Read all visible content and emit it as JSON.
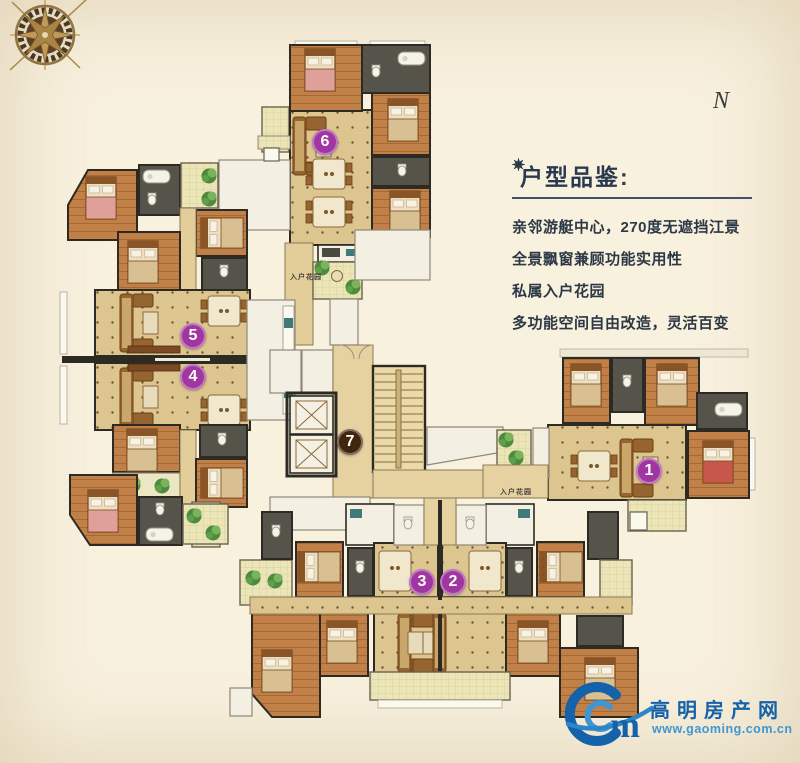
{
  "page": {
    "background": "#f8f1de"
  },
  "compass": {
    "label": "N"
  },
  "features": {
    "title": "户型品鉴:",
    "items": [
      "亲邻游艇中心，270度无遮挡江景",
      "全景飘窗兼顾功能实用性",
      "私属入户花园",
      "多功能空间自由改造，灵活百变"
    ]
  },
  "plan": {
    "unit_markers": [
      {
        "label": "1",
        "x": 649,
        "y": 471,
        "color": "#a036a0"
      },
      {
        "label": "2",
        "x": 453,
        "y": 582,
        "color": "#a036a0"
      },
      {
        "label": "3",
        "x": 422,
        "y": 582,
        "color": "#a036a0"
      },
      {
        "label": "4",
        "x": 193,
        "y": 377,
        "color": "#a036a0"
      },
      {
        "label": "5",
        "x": 193,
        "y": 336,
        "color": "#a036a0"
      },
      {
        "label": "6",
        "x": 325,
        "y": 142,
        "color": "#a036a0"
      },
      {
        "label": "7",
        "x": 350,
        "y": 442,
        "color": "#40260f"
      }
    ],
    "garden_labels": [
      {
        "text": "入户花园",
        "x": 306,
        "y": 277
      },
      {
        "text": "入户花园",
        "x": 516,
        "y": 492
      }
    ]
  },
  "watermark": {
    "logo_letter": "m",
    "site_name": "高明房产网",
    "url": "www.gaoming.com.cn",
    "blue": "#1462aa",
    "light_blue": "#3f96d2"
  }
}
